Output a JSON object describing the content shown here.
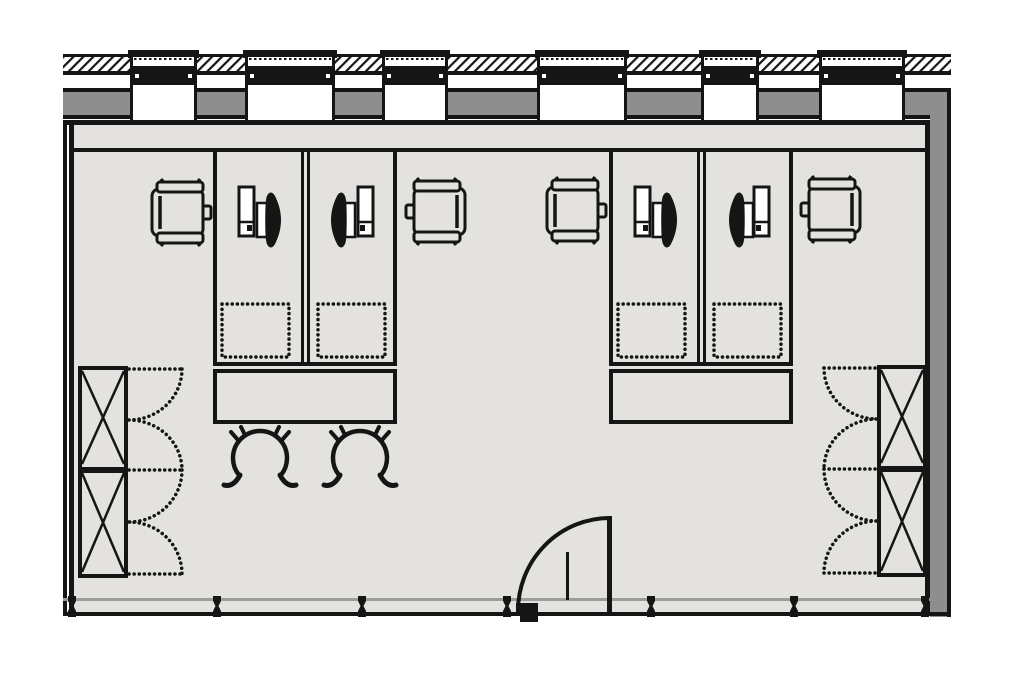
{
  "meta": {
    "title": "Office room floor plan",
    "drawing_type": "architectural plan, top-down view",
    "description": "Rectangular office room: glazed facade wall with six columns at top, window wall with entry door at bottom, two double-desk workstation clusters with PC towers and monitors, four office chairs, two visitor chairs, two side tables and two X-front storage cabinets with dashed double-door swings."
  },
  "colors": {
    "background": "#ffffff",
    "paper": "#ffffff",
    "ink": "#151515",
    "floor": "#e3e2df",
    "wall_gray": "#8e8e8e",
    "sill_gray": "#9c9c9c"
  },
  "legend": {
    "facade_columns": 6,
    "window_mullions": 7,
    "desks": 4,
    "pc_towers": 4,
    "monitors": 4,
    "office_chairs": 4,
    "visitor_chairs": 2,
    "side_tables": 2,
    "under_desk_pedestals": 4,
    "storage_cabinets": 2,
    "cabinet_door_swings": 8,
    "entry_doors": 1
  },
  "labels": {
    "plan": "Office room floor plan",
    "top_wall": "Glazed facade wall with columns and hatching",
    "bottom_wall": "Window wall with mullions and entry door",
    "left_wall": "Left partition wall",
    "right_wall": "Right wall",
    "left_cabinet": "Storage cabinet with double swing doors",
    "right_cabinet": "Storage cabinet with double swing doors",
    "left_cluster": "Workstation cluster with two desks",
    "right_cluster": "Workstation cluster with two desks",
    "door": "Entry door with quarter-circle swing arc",
    "visitor_chairs": "Visitor chairs",
    "office_chair": "Office chair",
    "monitor": "Monitor",
    "pc_tower": "PC tower",
    "side_table": "Side table",
    "pedestal": "Under-desk pedestal (dashed)"
  }
}
